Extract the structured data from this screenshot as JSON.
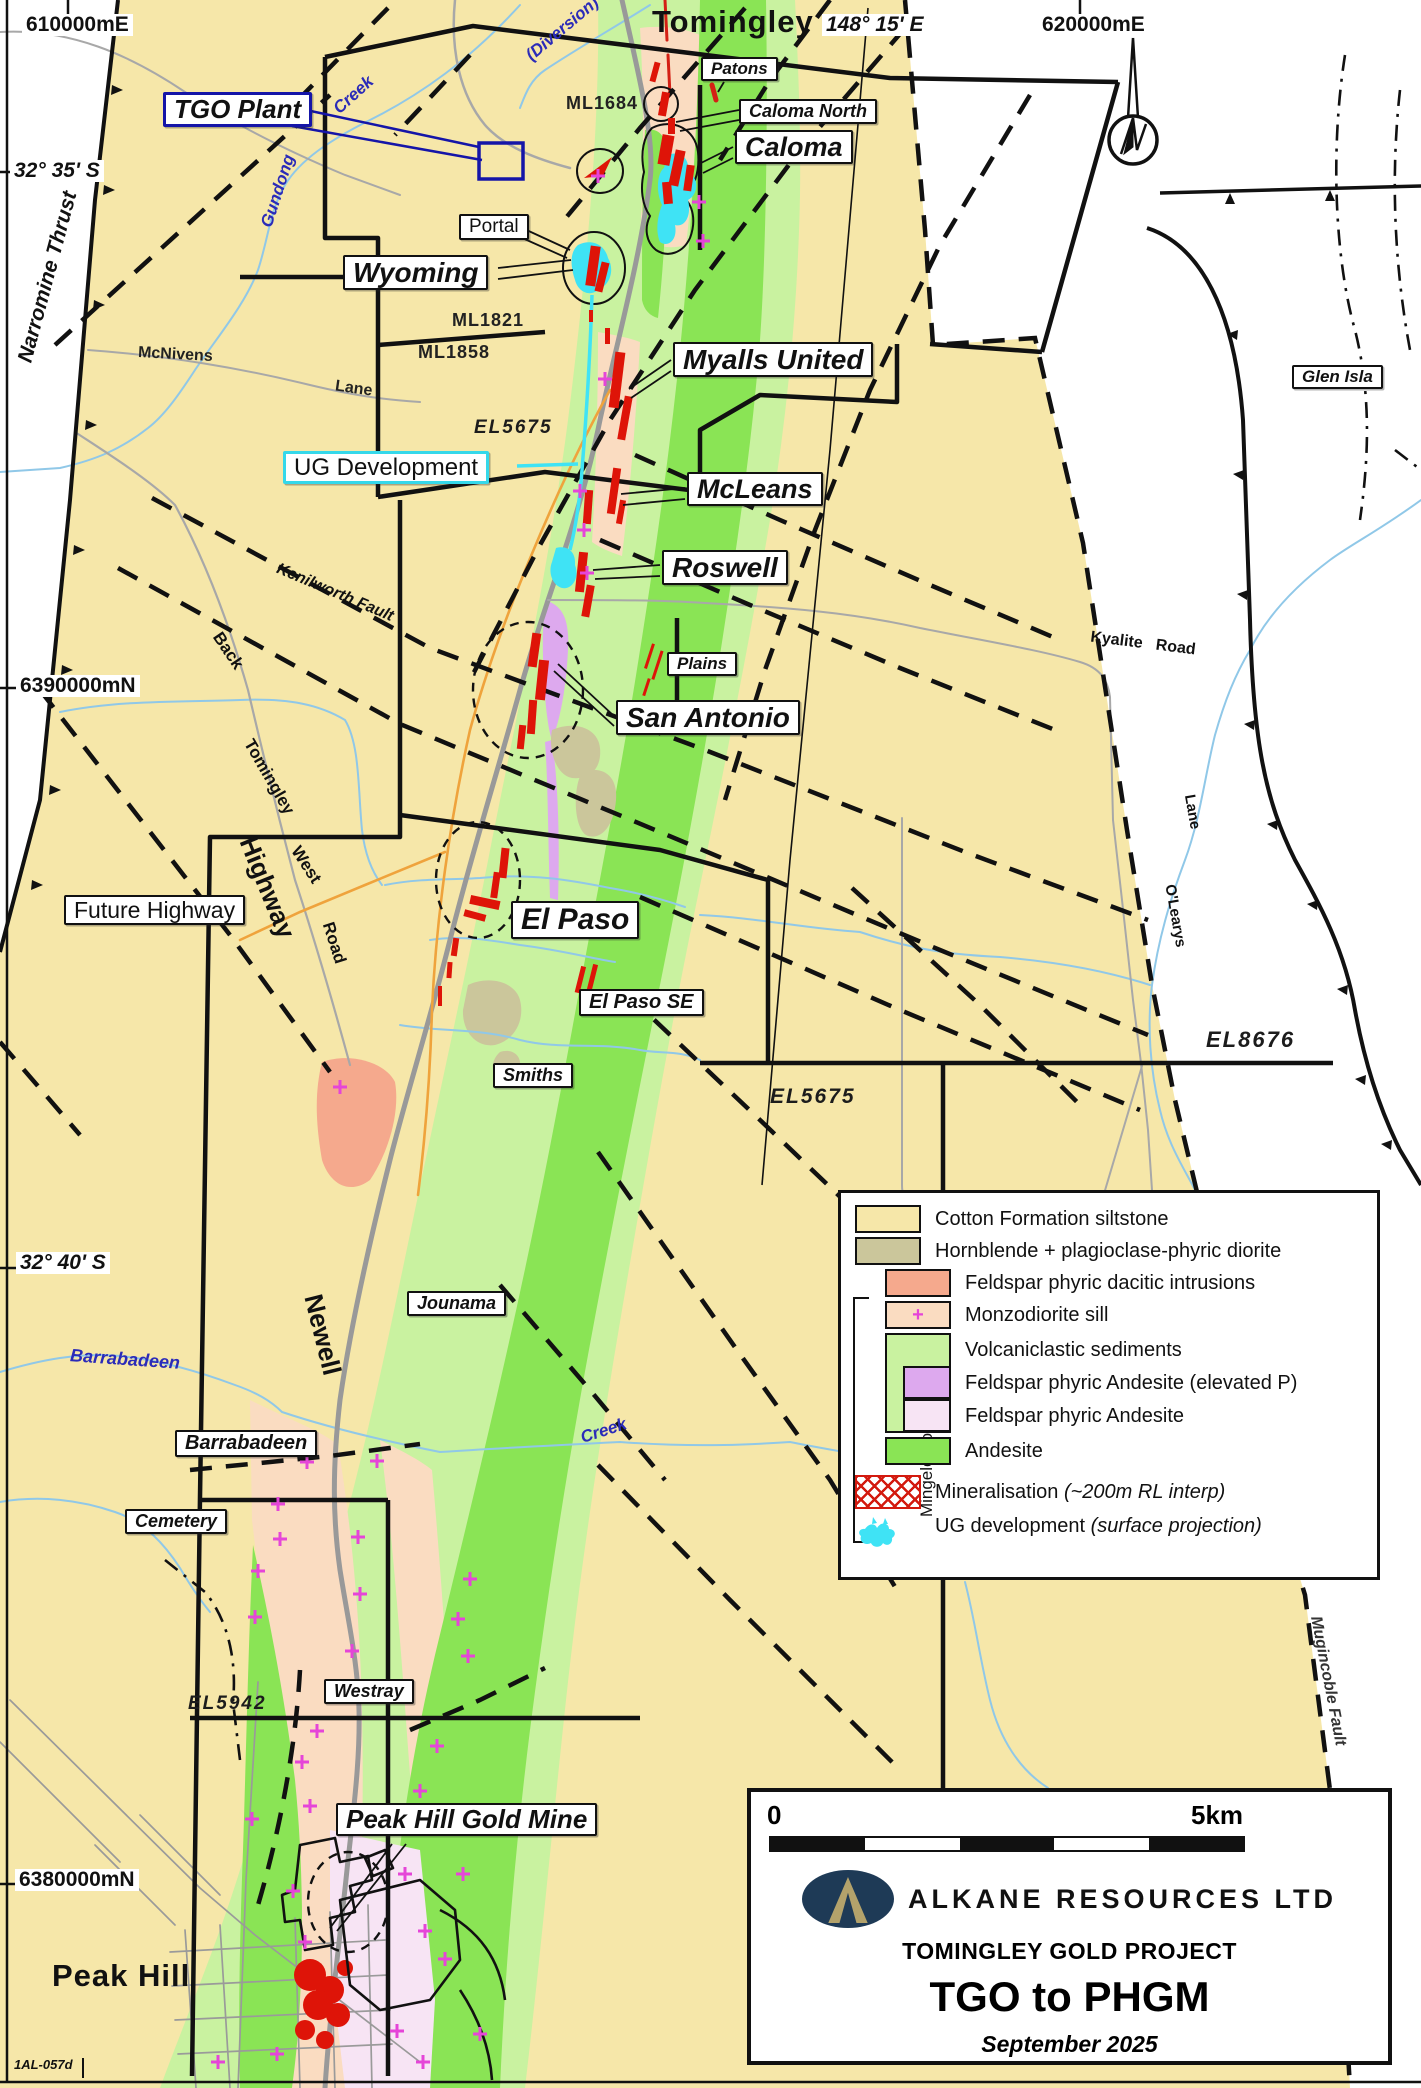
{
  "map": {
    "grid": {
      "easting_w": "610000mE",
      "easting_e": "620000mE",
      "longitude": "148° 15' E",
      "lat_n": "32° 35' S",
      "lat_s": "32° 40' S",
      "northing_n": "6390000mN",
      "northing_s": "6380000mN"
    },
    "towns": {
      "tomingley": "Tomingley",
      "peak_hill": "Peak Hill"
    },
    "labels": {
      "tgo_plant": "TGO Plant",
      "portal": "Portal",
      "wyoming": "Wyoming",
      "patons": "Patons",
      "caloma_north": "Caloma North",
      "caloma": "Caloma",
      "myalls_united": "Myalls United",
      "mcleans": "McLeans",
      "roswell": "Roswell",
      "plains": "Plains",
      "san_antonio": "San Antonio",
      "el_paso": "El Paso",
      "el_paso_se": "El Paso SE",
      "smiths": "Smiths",
      "jounama": "Jounama",
      "barrabadeen": "Barrabadeen",
      "cemetery": "Cemetery",
      "westray": "Westray",
      "glen_isla": "Glen Isla",
      "peak_hill_gold_mine": "Peak Hill Gold Mine",
      "ug_development": "UG Development",
      "future_highway": "Future Highway"
    },
    "tenements": {
      "ml1684": "ML1684",
      "ml1821": "ML1821",
      "ml1858": "ML1858",
      "el5675": "EL5675",
      "el5942": "EL5942",
      "el8676": "EL8676"
    },
    "faults": {
      "narromine": "Narromine Thrust",
      "kenilworth": "Kenilworth Fault",
      "mugincoble": "Mugincoble Fault"
    },
    "roads": {
      "newell": "Newell",
      "highway": "Highway",
      "back": "Back",
      "tomingley_rd": "Tomingley",
      "west": "West",
      "road": "Road",
      "mcnivens": "McNivens",
      "lane": "Lane",
      "kyalite_road": "Kyalite   Road",
      "olearys": "O'Learys",
      "olearys_lane": "Lane"
    },
    "creeks": {
      "gundong": "Gundong",
      "creek": "Creek",
      "diversion": "(Diversion)",
      "barrabadeen_creek": "Barrabadeen",
      "creek_se": "Creek"
    },
    "footnote": "1AL-057d"
  },
  "legend": {
    "group_label": "Mingelo Volcanics",
    "items": [
      {
        "label": "Cotton Formation siltstone",
        "color": "#F6E7A9"
      },
      {
        "label": "Hornblende + plagioclase-phyric diorite",
        "color": "#CBC69B"
      },
      {
        "label": "Feldspar phyric dacitic intrusions",
        "color": "#F5A98D"
      },
      {
        "label": "Monzodiorite sill",
        "color": "#FADCC1"
      },
      {
        "label": "Volcaniclastic sediments",
        "color": "#C9F2A0"
      },
      {
        "label": "Feldspar phyric Andesite (elevated P)",
        "color": "#DDA9EE"
      },
      {
        "label": "Feldspar phyric Andesite",
        "color": "#F7E4F4"
      },
      {
        "label": "Andesite",
        "color": "#8AE455"
      },
      {
        "label": "Mineralisation",
        "note": "(~200m RL interp)",
        "color": "#D31A0F"
      },
      {
        "label": "UG development",
        "note": "(surface projection)",
        "color": "#3FE3F5"
      }
    ]
  },
  "scalebar": {
    "start": "0",
    "end": "5km"
  },
  "title_block": {
    "company": "ALKANE RESOURCES LTD",
    "project": "TOMINGLEY GOLD PROJECT",
    "title": "TGO to PHGM",
    "date": "September 2025"
  },
  "colors": {
    "cotton": "#F6E7A9",
    "pale_green": "#C9F2A0",
    "bright_green": "#8AE455",
    "peach": "#FADCC1",
    "salmon": "#F5A98D",
    "purple": "#DDA9EE",
    "pale_pink": "#F7E4F4",
    "khaki": "#CBC69B",
    "mineral_red": "#DE1408",
    "ug_cyan": "#3FE3F5",
    "creek_blue": "#90C8E8",
    "road_gray": "#999999",
    "future_highway_orange": "#EFA33C",
    "logo_navy": "#1E3A56",
    "logo_gold": "#B3A26B",
    "tgo_callout_blue": "#1515A8",
    "plus_magenta": "#E545D8"
  }
}
